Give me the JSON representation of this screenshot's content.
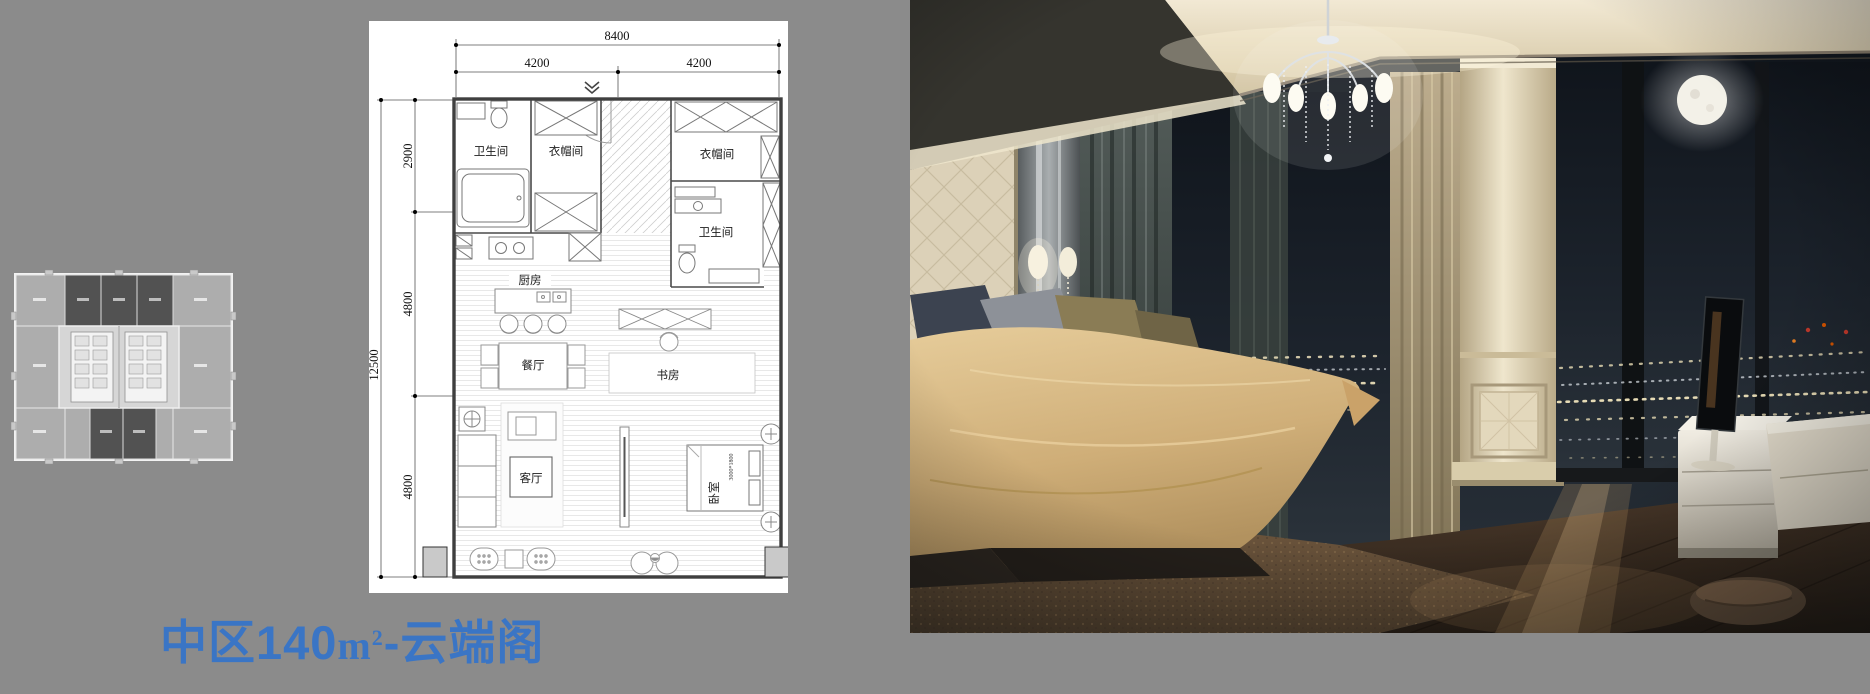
{
  "page": {
    "background_color": "#8b8b8b",
    "accent_color": "#3a75c5"
  },
  "title": {
    "prefix": "中区140",
    "area_unit_base": "m",
    "area_unit_sup": "2",
    "suffix": "-云端阁"
  },
  "floor_plan": {
    "dims": {
      "overall_width": "8400",
      "bay_left": "4200",
      "bay_right": "4200",
      "overall_depth": "12500",
      "depth_top": "2900",
      "depth_mid": "4800",
      "depth_bottom": "4800",
      "bed_size": "3000*1800"
    },
    "rooms": {
      "bathroom_1": "卫生间",
      "closet_1": "衣帽间",
      "closet_2": "衣帽间",
      "bathroom_2": "卫生间",
      "kitchen": "厨房",
      "dining": "餐厅",
      "study": "书房",
      "living": "客厅",
      "bedroom": "卧室"
    }
  }
}
